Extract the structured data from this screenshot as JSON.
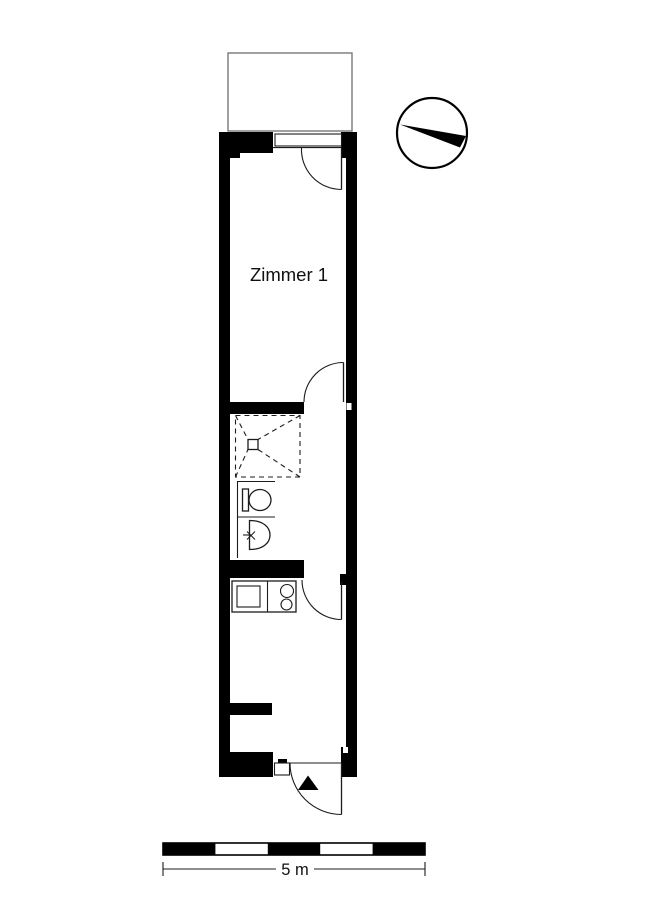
{
  "plan": {
    "room_label": "Zimmer 1",
    "scale_bar": {
      "label": "5 m",
      "meters": 5,
      "segments": 5
    },
    "colors": {
      "background": "#ffffff",
      "walls": "#000000",
      "thin_line": "#1c1c1c",
      "balcony_line": "#777777"
    },
    "icons": {
      "compass": "north-arrow-compass",
      "entrance_marker": "filled-triangle-entrance",
      "fixtures": [
        "shower-tray",
        "toilet",
        "washbasin",
        "kitchen-counter",
        "stove-two-burners"
      ],
      "doors": [
        "balcony-door",
        "room-door",
        "kitchen-door",
        "entrance-door"
      ]
    }
  }
}
